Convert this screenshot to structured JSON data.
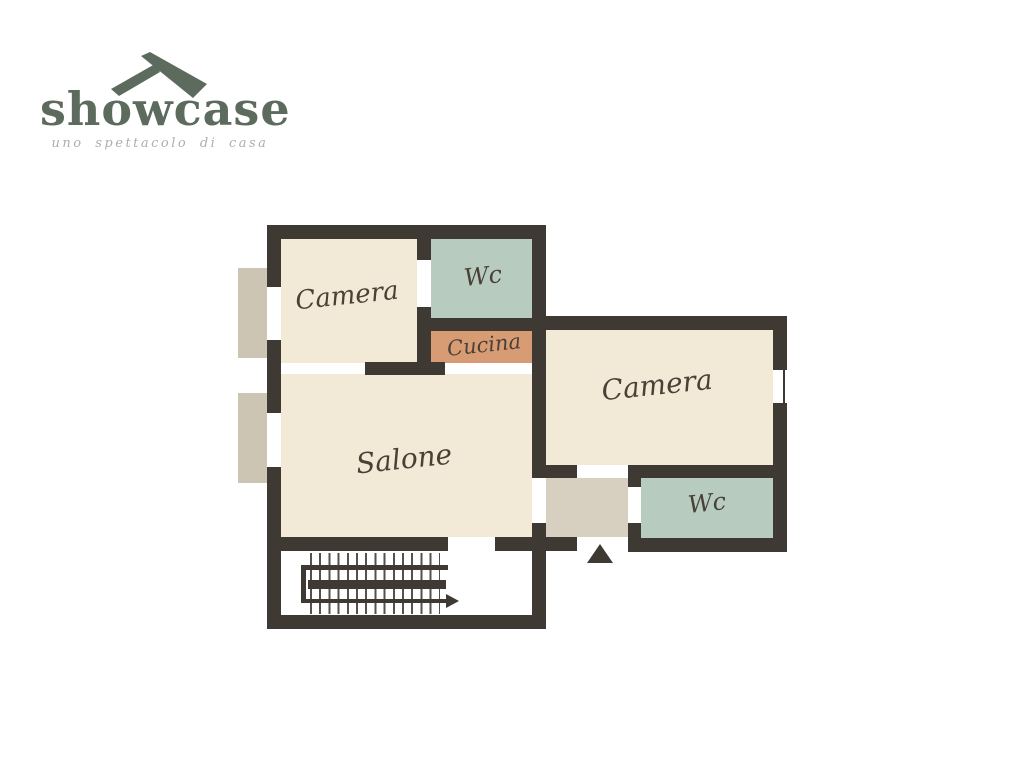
{
  "logo": {
    "title": "showcase",
    "tagline": "uno spettacolo di casa"
  },
  "rooms": [
    {
      "id": "camera-1",
      "label": "Camera",
      "type": "bedroom"
    },
    {
      "id": "wc-1",
      "label": "Wc",
      "type": "bathroom"
    },
    {
      "id": "cucina",
      "label": "Cucina",
      "type": "kitchen"
    },
    {
      "id": "salone",
      "label": "Salone",
      "type": "living-room"
    },
    {
      "id": "camera-2",
      "label": "Camera",
      "type": "bedroom"
    },
    {
      "id": "wc-2",
      "label": "Wc",
      "type": "bathroom"
    }
  ],
  "icons": {
    "roof": "roof-icon",
    "entry": "entry-triangle-up-icon",
    "stairs": "stairs-arrow-right-icon"
  },
  "colors": {
    "wall": "#3e3933",
    "room_cream": "#f2e9d7",
    "room_sage": "#b7cbbe",
    "room_terracotta": "#d89c75",
    "balcony": "#ccc5b4",
    "hall": "#d7d0c1",
    "logo_green": "#5d6b5e",
    "tagline_gray": "#a9b2a7",
    "label_brown": "#4a4136"
  }
}
